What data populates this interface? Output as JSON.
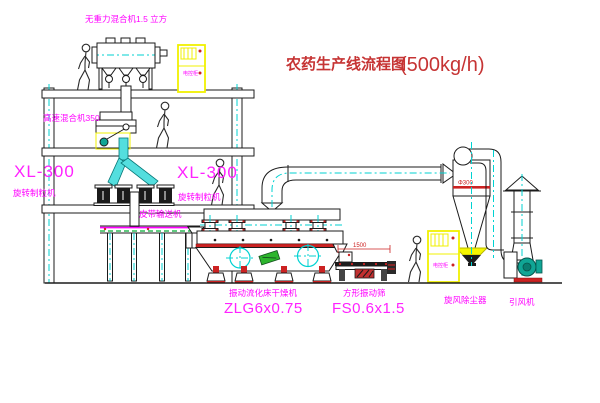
{
  "title": {
    "name": "农药生产线流程图",
    "capacity": "(500kg/h)"
  },
  "equipment": {
    "gravity_mixer": {
      "label": "无重力混合机1.5 立方"
    },
    "high_speed_mixer": {
      "label": "高速混合机350"
    },
    "granulator_left": {
      "model": "XL-300",
      "name": "旋转制粒机"
    },
    "granulator_right": {
      "model": "XL-300",
      "name": "旋转制粒机"
    },
    "belt_conveyor": {
      "label": "皮带输送机"
    },
    "fluid_bed_dryer": {
      "name": "振动流化床干燥机",
      "model": "ZLG6x0.75"
    },
    "square_sieve": {
      "name": "方形振动筛",
      "model": "FS0.6x1.5",
      "dimension": "1500"
    },
    "cyclone": {
      "name": "旋风除尘器",
      "dimension": "Φ300"
    },
    "induced_draft_fan": {
      "name": "引风机"
    },
    "control_cabinet": {
      "label": "电控柜"
    }
  },
  "colors": {
    "label_magenta": "#ff00ff",
    "title_red": "#c63434",
    "line_black": "#1b1b1b",
    "centerline_cyan": "#00d2d2",
    "cabinet_yellow": "#f0f000",
    "vibrate_red": "#cc2222",
    "belt_green": "#00aa33",
    "fan_teal": "#10a595"
  }
}
